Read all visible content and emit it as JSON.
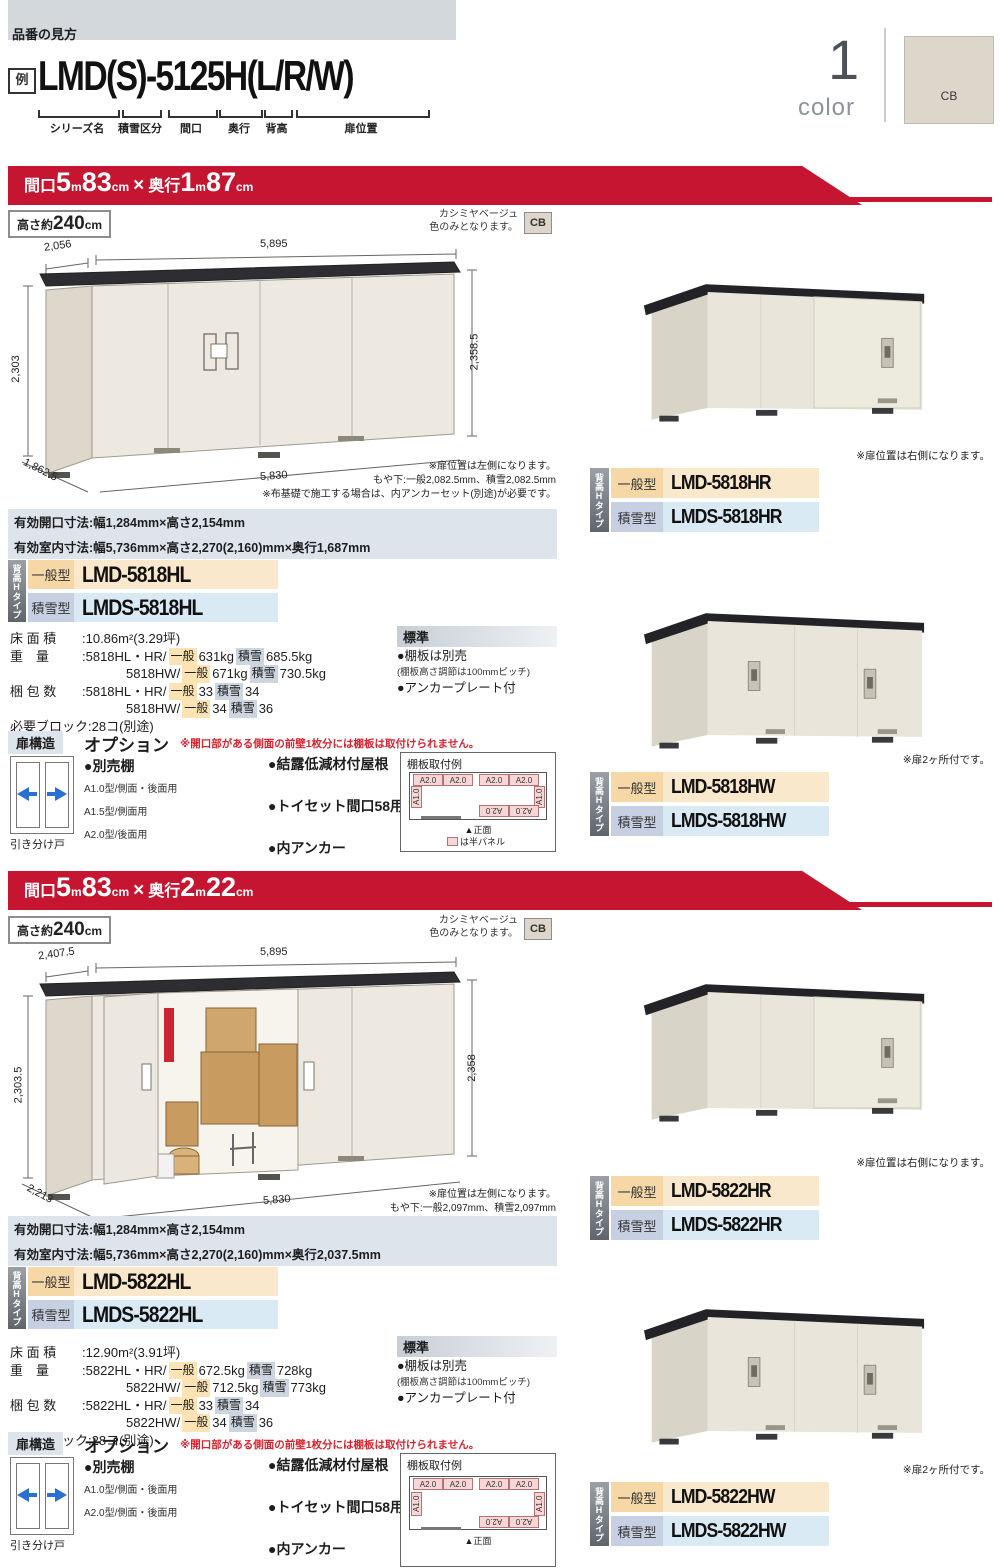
{
  "header": {
    "lead": "品番の見方",
    "example": "例",
    "code": "LMD(S)-5125H(L/R/W)",
    "labels": [
      "シリーズ名",
      "積雪区分",
      "間口",
      "奥行",
      "背高",
      "扉位置"
    ],
    "count": "1",
    "count_word": "color",
    "swatch": "CB"
  },
  "sections": [
    {
      "banner": {
        "t1": "間口",
        "v1": "5",
        "u1": "m",
        "v2": "83",
        "u2": "cm",
        "sep": "×",
        "t2": "奥行",
        "v3": "1",
        "u3": "m",
        "v4": "87",
        "u4": "cm"
      },
      "height_box": {
        "prefix": "高さ約",
        "value": "240",
        "unit": "cm"
      },
      "color_note": {
        "line1": "カシミヤベージュ",
        "line2": "色のみとなります。",
        "chip": "CB"
      },
      "drawing": {
        "dim_top_left": "2,056",
        "dim_top": "5,895",
        "dim_left": "2,303",
        "dim_right": "2,358.5",
        "dim_diag": "1,862.5",
        "dim_bottom": "5,830",
        "notes": [
          "※扉位置は左側になります。",
          "もや下:一般2,082.5mm、積雪2,082.5mm",
          "※布基礎で施工する場合は、内アンカーセット(別途)が必要です。"
        ]
      },
      "spec_bars": [
        "有効開口寸法:幅1,284mm×高さ2,154mm",
        "有効室内寸法:幅5,736mm×高さ2,270(2,160)mm×奥行1,687mm"
      ],
      "models": {
        "tab": "背高Hタイプ",
        "general_label": "一般型",
        "general_code": "LMD-5818HL",
        "snow_label": "積雪型",
        "snow_code": "LMDS-5818HL"
      },
      "specs": {
        "floor_label": "床 面 積",
        "floor_value": ":10.86m²(3.29坪)",
        "weight_label": "重　量",
        "weight_rows": [
          {
            "prefix": ":5818HL・HR/",
            "g": "一般",
            "gv": "631kg",
            "s": "積雪",
            "sv": "685.5kg"
          },
          {
            "prefix": "5818HW/",
            "g": "一般",
            "gv": "671kg",
            "s": "積雪",
            "sv": "730.5kg"
          }
        ],
        "pack_label": "梱 包 数",
        "pack_rows": [
          {
            "prefix": ":5818HL・HR/",
            "g": "一般",
            "gv": "33",
            "s": "積雪",
            "sv": "34"
          },
          {
            "prefix": "5818HW/",
            "g": "一般",
            "gv": "34",
            "s": "積雪",
            "sv": "36"
          }
        ],
        "blocks": "必要ブロック:28コ(別途)"
      },
      "standard": {
        "title": "標準",
        "items": [
          "●棚板は別売",
          "(棚板高さ調節は100mmピッチ)",
          "●アンカープレート付"
        ]
      },
      "options": {
        "door_title": "扉構造",
        "title": "オプション",
        "warning": "※開口部がある側面の前壁1枚分には棚板は取付けられません。",
        "door_caption": "引き分け戸",
        "shelf_title": "●別売棚",
        "shelf_items": [
          "A1.0型/側面・後面用",
          "A1.5型/側面用",
          "A2.0型/後面用"
        ],
        "items": [
          "●結露低減材付屋根",
          "●トイセット間口58用",
          "●内アンカー"
        ],
        "items_note": "(連結部は付属のプレートを使用)",
        "shelf_example": {
          "title": "棚板取付例",
          "cells_top": [
            "A2.0",
            "A2.0",
            "A2.0",
            "A2.0"
          ],
          "cell_left": "A1.0",
          "cell_right": "A1.0",
          "cells_bottom": [
            "A2.0",
            "A2.0"
          ],
          "front_caption": "▲正面",
          "legend": "は半パネル"
        }
      },
      "products": [
        {
          "note": "※扉位置は右側になります。",
          "tab": "背高Hタイプ",
          "general_label": "一般型",
          "general_code": "LMD-5818HR",
          "snow_label": "積雪型",
          "snow_code": "LMDS-5818HR"
        },
        {
          "note": "※扉2ヶ所付です。",
          "tab": "背高Hタイプ",
          "general_label": "一般型",
          "general_code": "LMD-5818HW",
          "snow_label": "積雪型",
          "snow_code": "LMDS-5818HW"
        }
      ]
    },
    {
      "banner": {
        "t1": "間口",
        "v1": "5",
        "u1": "m",
        "v2": "83",
        "u2": "cm",
        "sep": "×",
        "t2": "奥行",
        "v3": "2",
        "u3": "m",
        "v4": "22",
        "u4": "cm"
      },
      "height_box": {
        "prefix": "高さ約",
        "value": "240",
        "unit": "cm"
      },
      "color_note": {
        "line1": "カシミヤベージュ",
        "line2": "色のみとなります。",
        "chip": "CB"
      },
      "drawing": {
        "dim_top_left": "2,407.5",
        "dim_top": "5,895",
        "dim_left": "2,303.5",
        "dim_right": "2,358",
        "dim_diag": "2,213",
        "dim_bottom": "5,830",
        "notes": [
          "※扉位置は左側になります。",
          "もや下:一般2,097mm、積雪2,097mm",
          "※布基礎で施工する場合は、内アンカーセット(別途)が必要です。"
        ]
      },
      "spec_bars": [
        "有効開口寸法:幅1,284mm×高さ2,154mm",
        "有効室内寸法:幅5,736mm×高さ2,270(2,160)mm×奥行2,037.5mm"
      ],
      "models": {
        "tab": "背高Hタイプ",
        "general_label": "一般型",
        "general_code": "LMD-5822HL",
        "snow_label": "積雪型",
        "snow_code": "LMDS-5822HL"
      },
      "specs": {
        "floor_label": "床 面 積",
        "floor_value": ":12.90m²(3.91坪)",
        "weight_label": "重　量",
        "weight_rows": [
          {
            "prefix": ":5822HL・HR/",
            "g": "一般",
            "gv": "672.5kg",
            "s": "積雪",
            "sv": "728kg"
          },
          {
            "prefix": "5822HW/",
            "g": "一般",
            "gv": "712.5kg",
            "s": "積雪",
            "sv": "773kg"
          }
        ],
        "pack_label": "梱 包 数",
        "pack_rows": [
          {
            "prefix": ":5822HL・HR/",
            "g": "一般",
            "gv": "33",
            "s": "積雪",
            "sv": "34"
          },
          {
            "prefix": "5822HW/",
            "g": "一般",
            "gv": "34",
            "s": "積雪",
            "sv": "36"
          }
        ],
        "blocks": "必要ブロック:28コ(別途)"
      },
      "standard": {
        "title": "標準",
        "items": [
          "●棚板は別売",
          "(棚板高さ調節は100mmピッチ)",
          "●アンカープレート付"
        ]
      },
      "options": {
        "door_title": "扉構造",
        "title": "オプション",
        "warning": "※開口部がある側面の前壁1枚分には棚板は取付けられません。",
        "door_caption": "引き分け戸",
        "shelf_title": "●別売棚",
        "shelf_items": [
          "A1.0型/側面・後面用",
          "A2.0型/側面・後面用"
        ],
        "items": [
          "●結露低減材付屋根",
          "●トイセット間口58用",
          "●内アンカー"
        ],
        "items_note": "(連結部は付属のプレートを使用)",
        "shelf_example": {
          "title": "棚板取付例",
          "cells_top": [
            "A2.0",
            "A2.0",
            "A2.0",
            "A2.0"
          ],
          "cell_left": "A1.0",
          "cell_right": "A1.0",
          "cells_bottom": [
            "A2.0",
            "A2.0"
          ],
          "front_caption": "▲正面",
          "legend": ""
        }
      },
      "products": [
        {
          "note": "※扉位置は右側になります。",
          "tab": "背高Hタイプ",
          "general_label": "一般型",
          "general_code": "LMD-5822HR",
          "snow_label": "積雪型",
          "snow_code": "LMDS-5822HR"
        },
        {
          "note": "※扉2ヶ所付です。",
          "tab": "背高Hタイプ",
          "general_label": "一般型",
          "general_code": "LMD-5822HW",
          "snow_label": "積雪型",
          "snow_code": "LMDS-5822HW"
        }
      ]
    }
  ]
}
